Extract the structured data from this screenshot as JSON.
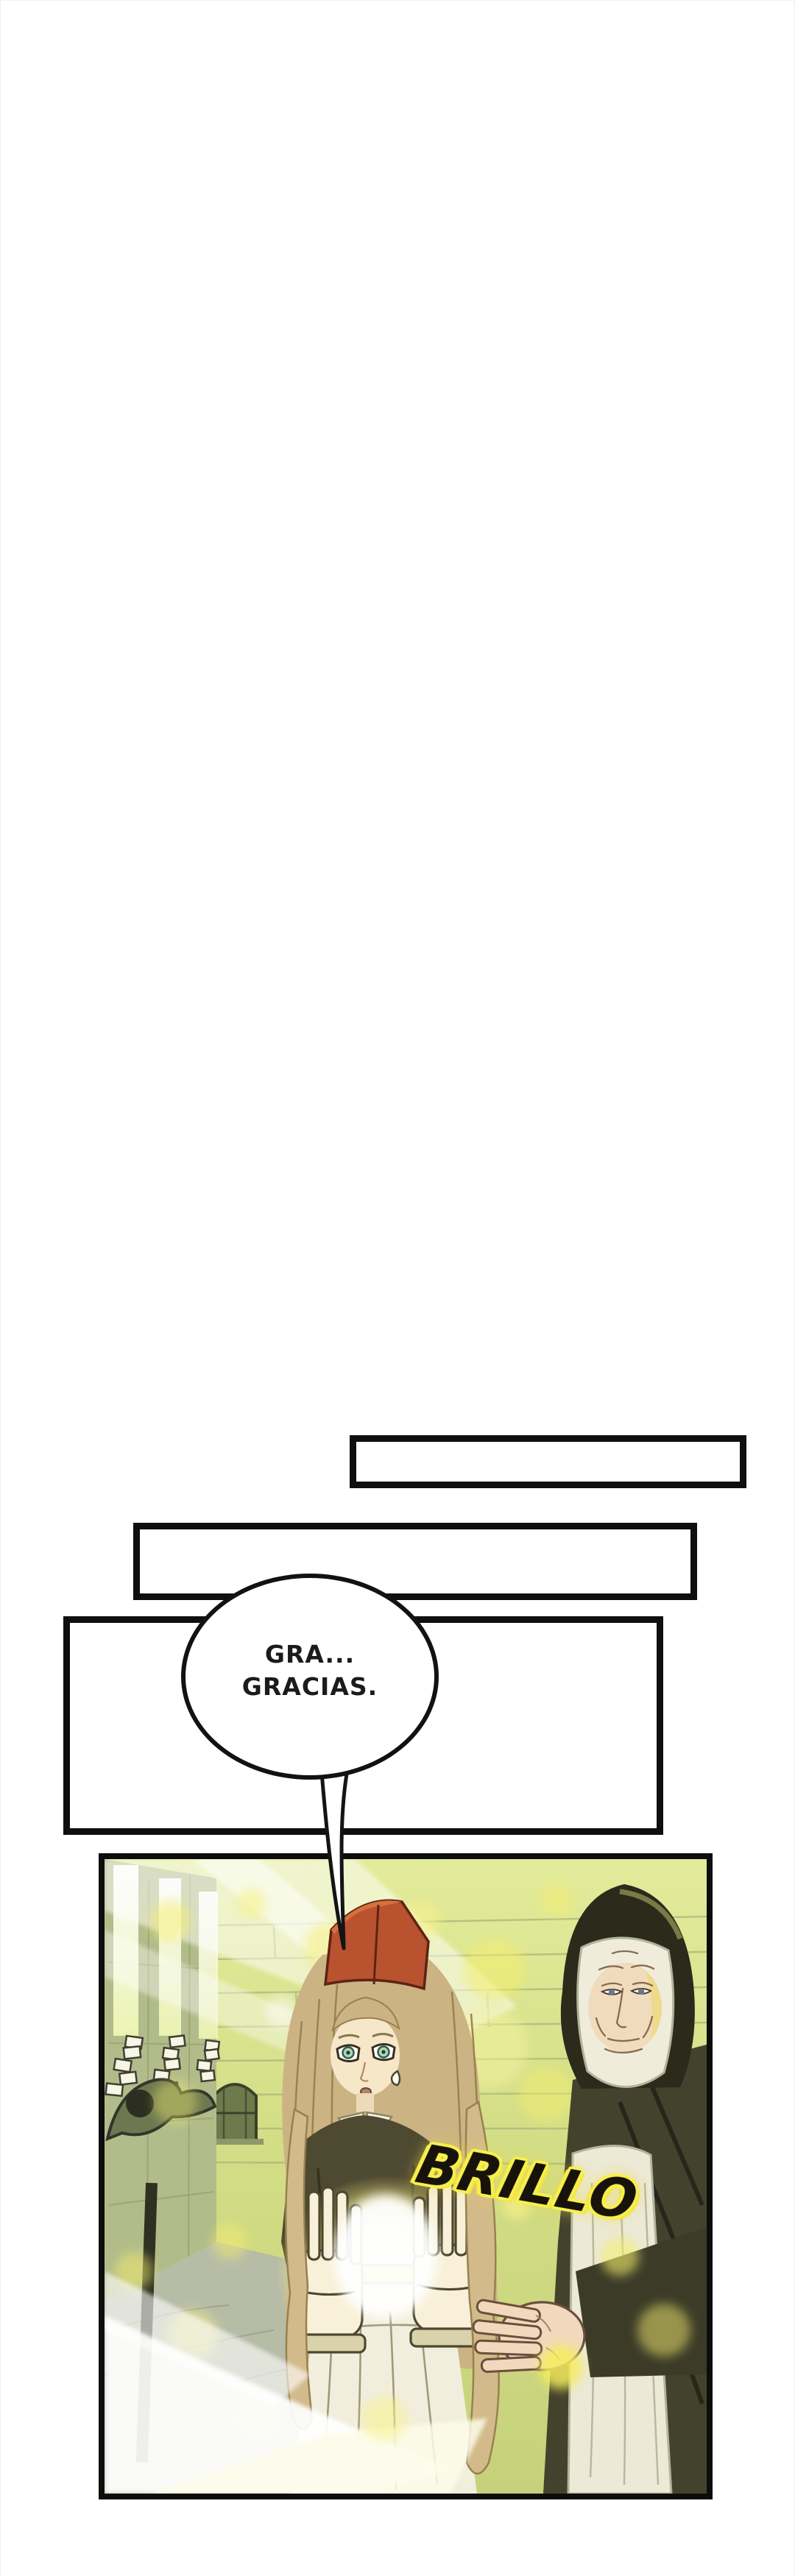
{
  "page": {
    "background": "#ffffff"
  },
  "boxes": {
    "box1": "",
    "box2": "",
    "box3": ""
  },
  "bubble": {
    "line1": "GRA...",
    "line2": "GRACIAS."
  },
  "sfx": {
    "text": "BRILLO",
    "text_color": "#17130a",
    "outline_color": "#f7ef4e"
  },
  "palette": {
    "box_border": "#0f0f0f",
    "panel_border": "#0d0d0d",
    "art_base_green": "#cdd680",
    "glow_yellow": "#f3ee6d",
    "cap_red": "#b9522e",
    "hair_tan": "#ccb384",
    "girl_coat_olive": "#4e4931",
    "nun_habit_dark": "#43422c",
    "nun_veil": "#2b2a1b",
    "wimple_white": "#edeadb",
    "skin": "#f4e2c2"
  }
}
